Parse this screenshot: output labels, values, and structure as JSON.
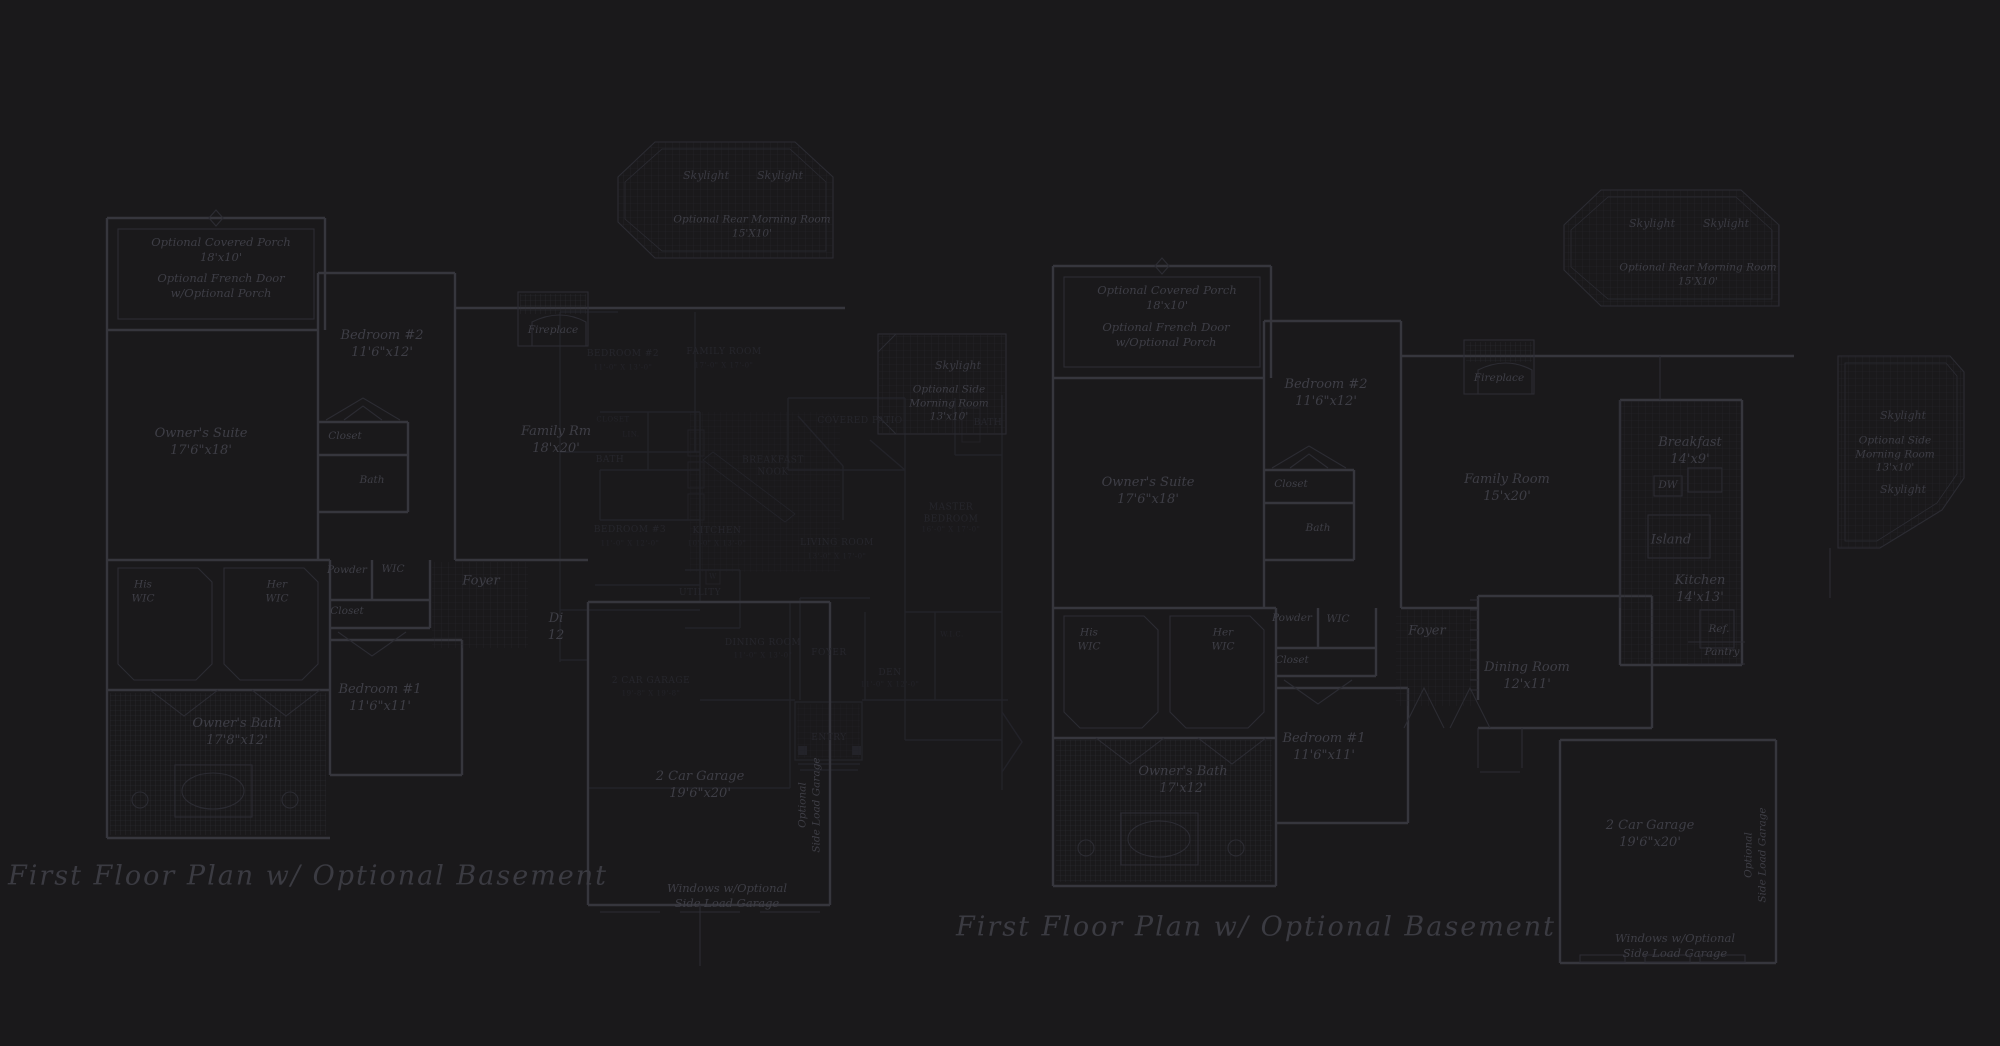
{
  "palette": {
    "background": "#1a191b",
    "bright_line": "#36363d",
    "medium_line": "#2c2c33",
    "dim_line": "#232329",
    "bright_text": "#3e3e46",
    "dim_text": "#26262c",
    "title_text": "#3b3b42"
  },
  "lp": {
    "title": "First Floor Plan  w/ Optional Basement",
    "porch": "Optional Covered Porch\n18'x10'",
    "french": "Optional French Door\nw/Optional Porch",
    "bedroom2": "Bedroom #2\n11'6\"x12'",
    "suite": "Owner's Suite\n17'6\"x18'",
    "closet_b2": "Closet",
    "bath_b2": "Bath",
    "fireplace": "Fireplace",
    "family": "Family Rm\n18'x20'",
    "his_wic": "His\nWIC",
    "her_wic": "Her\nWIC",
    "powder": "Powder",
    "wic": "WIC",
    "closet_hall": "Closet",
    "foyer": "Foyer",
    "dining_frag": "Di\n12",
    "bedroom1": "Bedroom #1\n11'6\"x11'",
    "bath_owner": "Owner's Bath\n17'8\"x12'",
    "garage": "2 Car Garage\n19'6\"x20'",
    "garage_note": "Windows w/Optional\nSide Load Garage",
    "side_load": "Optional\nSide Load Garage",
    "sky1": "Skylight",
    "sky2": "Skylight",
    "rear_morning": "Optional Rear Morning Room\n15'X10'",
    "side_sky": "Skylight",
    "side_morning": "Optional Side\nMorning Room\n13'x10'"
  },
  "rp": {
    "title": "First Floor Plan  w/ Optional Basement",
    "porch": "Optional Covered Porch\n18'x10'",
    "french": "Optional French Door\nw/Optional Porch",
    "bedroom2": "Bedroom #2\n11'6\"x12'",
    "suite": "Owner's Suite\n17'6\"x18'",
    "closet_b2": "Closet",
    "bath_b2": "Bath",
    "fireplace": "Fireplace",
    "family": "Family Room\n15'x20'",
    "breakfast": "Breakfast\n14'x9'",
    "dw": "DW",
    "island": "Island",
    "kitchen": "Kitchen\n14'x13'",
    "ref": "Ref.",
    "pantry": "Pantry",
    "his_wic": "His\nWIC",
    "her_wic": "Her\nWIC",
    "powder": "Powder",
    "wic": "WIC",
    "closet_hall": "Closet",
    "foyer": "Foyer",
    "dining": "Dining Room\n12'x11'",
    "bedroom1": "Bedroom #1\n11'6\"x11'",
    "bath_owner": "Owner's Bath\n17'x12'",
    "garage": "2 Car Garage\n19'6\"x20'",
    "garage_note": "Windows w/Optional\nSide Load Garage",
    "side_load": "Optional\nSide Load Garage",
    "sky1": "Skylight",
    "sky2": "Skylight",
    "rear_morning": "Optional Rear Morning Room\n15'X10'",
    "side_sky1": "Skylight",
    "side_morning": "Optional Side\nMorning Room\n13'x10'",
    "side_sky2": "Skylight"
  },
  "ul": {
    "bedroom2": "BEDROOM #2",
    "bedroom2_d": "11'-0\" X 13'-0\"",
    "family": "FAMILY ROOM",
    "family_d": "17'-0\" X 17'-0\"",
    "closet": "CLOSET",
    "lin": "LIN.",
    "bath_hall": "BATH",
    "bedroom3": "BEDROOM #3",
    "bedroom3_d": "11'-0\" X 12'-0\"",
    "breakfast": "BREAKFAST\nNOOK",
    "kitchen": "KITCHEN",
    "kitchen_d": "10'-0\" X 13'-0\"",
    "living": "LIVING ROOM",
    "living_d": "13'-0\" X 17'-0\"",
    "utility": "UTILITY",
    "washer": "W",
    "dining": "DINING ROOM",
    "dining_d": "11'-0\" X 13'-0\"",
    "foyer": "FOYER",
    "den": "DEN",
    "den_d": "11'-0\" X 12'-0\"",
    "entry": "ENTRY",
    "patio": "COVERED PATIO",
    "master": "MASTER\nBEDROOM",
    "master_d": "16'-0\" X 17'-0\"",
    "bath_m": "BATH",
    "wic": "W.I.C.",
    "garage": "2 CAR GARAGE",
    "garage_d": "19'-8\" X 19'-8\""
  }
}
